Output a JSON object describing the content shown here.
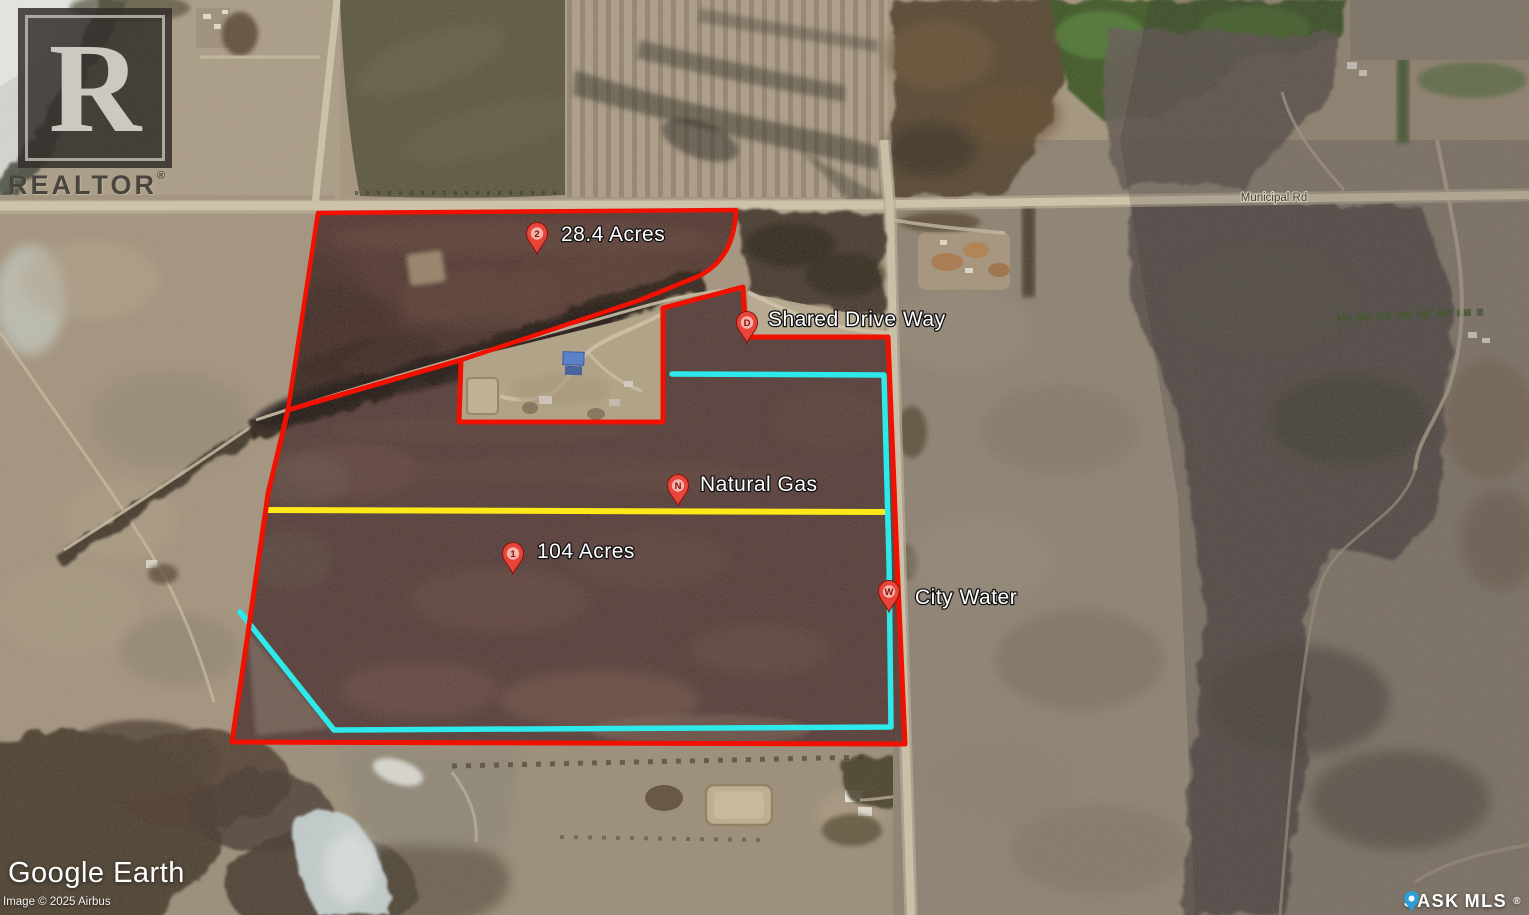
{
  "annotations": {
    "road_label": "Municipal Rd",
    "pins": [
      {
        "id": "2",
        "label": "28.4 Acres"
      },
      {
        "id": "D",
        "label": "Shared Drive Way"
      },
      {
        "id": "N",
        "label": "Natural Gas"
      },
      {
        "id": "1",
        "label": "104 Acres"
      },
      {
        "id": "W",
        "label": "City Water"
      }
    ]
  },
  "watermarks": {
    "realtor_letter": "R",
    "realtor_word": "REALTOR",
    "realtor_reg": "®",
    "google_earth": "Google Earth",
    "imagery_credit": "Image © 2025 Airbus",
    "mls_left": "SASK",
    "mls_right": "MLS",
    "mls_reg": "®"
  },
  "colors": {
    "parcel_boundary": "#f21000",
    "water_line": "#2de9ea",
    "gas_line": "#fde818",
    "pin_fill": "#e8453a",
    "mls_pin_fill": "#2e9fd6"
  }
}
